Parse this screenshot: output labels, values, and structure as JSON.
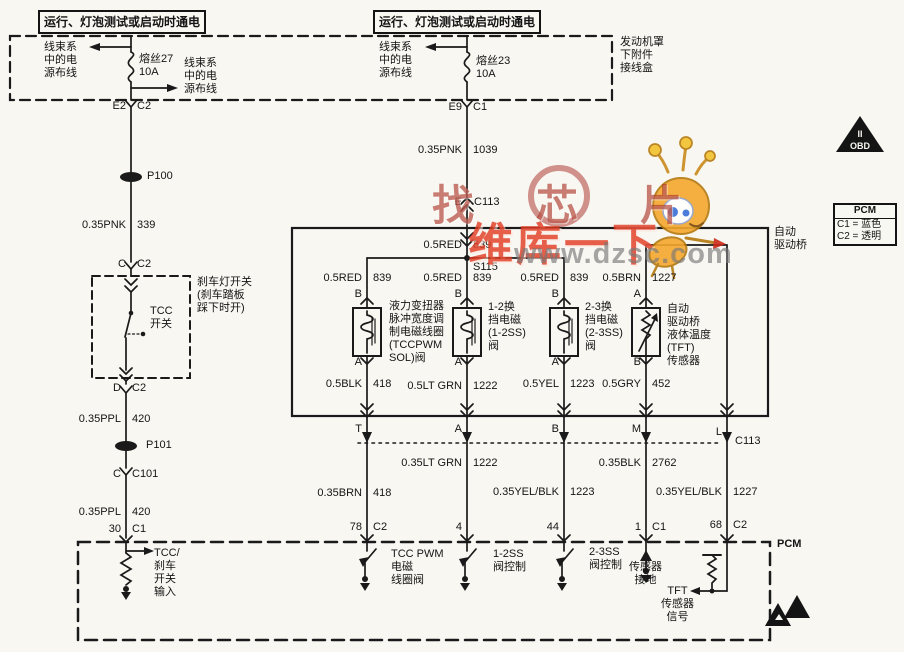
{
  "header": {
    "power_title_left": "运行、灯泡测试或启动时通电",
    "power_title_right": "运行、灯泡测试或启动时通电",
    "junction_box": "发动机罩\n下附件\n接线盒",
    "fuse27": {
      "label": "熔丝27\n10A",
      "left_note": "线束系\n中的电\n源布线",
      "right_note": "线束系\n中的电\n源布线",
      "pin": "E2",
      "conn": "C2"
    },
    "fuse23": {
      "label": "熔丝23\n10A",
      "left_note": "线束系\n中的电\n源布线",
      "pin": "E9",
      "conn": "C1"
    }
  },
  "left_circuit": {
    "p100": "P100",
    "p101": "P101",
    "wire_339": {
      "spec": "0.35PNK",
      "num": "339"
    },
    "conn_c_c2": {
      "pin": "C",
      "conn": "C2"
    },
    "brake_switch_note": "刹车灯开关\n(刹车踏板\n踩下时开)",
    "tcc_switch": "TCC\n开关",
    "conn_d_c2": {
      "pin": "D",
      "conn": "C2"
    },
    "wire_420a": {
      "spec": "0.35PPL",
      "num": "420"
    },
    "conn_c_c101": {
      "pin": "C",
      "conn": "C101"
    },
    "wire_420b": {
      "spec": "0.35PPL",
      "num": "420"
    },
    "pin_30": {
      "pin": "30",
      "conn": "C1"
    },
    "pcm_input": "TCC/\n刹车\n开关\n输入"
  },
  "center_circuit": {
    "wire_1039": {
      "spec": "0.35PNK",
      "num": "1039"
    },
    "conn_e_c113": {
      "pin": "E",
      "conn": "C113"
    },
    "wire_839_main": {
      "spec": "0.5RED",
      "num": "839"
    },
    "splice": "S115"
  },
  "transaxle": {
    "label": "自动\n驱动桥",
    "branches": [
      {
        "wire": {
          "spec": "0.5RED",
          "num": "839"
        },
        "top_term": "B",
        "bottom_term": "A",
        "device": "液力变扭器\n脉冲宽度调\n制电磁线圈\n(TCCPWM\nSOL)阀",
        "bottom_wire": {
          "spec": "0.5BLK",
          "num": "418"
        }
      },
      {
        "wire": {
          "spec": "0.5RED",
          "num": "839"
        },
        "top_term": "B",
        "bottom_term": "A",
        "device": "1-2换\n挡电磁\n(1-2SS)\n阀",
        "bottom_wire": {
          "spec": "0.5LT GRN",
          "num": "1222"
        }
      },
      {
        "wire": {
          "spec": "0.5RED",
          "num": "839"
        },
        "top_term": "B",
        "bottom_term": "A",
        "device": "2-3换\n挡电磁\n(2-3SS)\n阀",
        "bottom_wire": {
          "spec": "0.5YEL",
          "num": "1223"
        }
      },
      {
        "wire": {
          "spec": "0.5BRN",
          "num": "1227"
        },
        "top_term": "A",
        "bottom_term": "B",
        "device": "自动\n驱动桥\n液体温度\n(TFT)\n传感器",
        "bottom_wire": {
          "spec": "0.5GRY",
          "num": "452"
        }
      }
    ]
  },
  "c113": {
    "label": "C113",
    "terminals": [
      "T",
      "A",
      "B",
      "M",
      "L"
    ],
    "wires": [
      {
        "spec": "0.35BRN",
        "num": "418",
        "pin": "78",
        "conn": "C2"
      },
      {
        "spec": "0.35LT GRN",
        "num": "1222",
        "pin": "4",
        "conn": ""
      },
      {
        "spec": "0.35YEL/BLK",
        "num": "1223",
        "pin": "44",
        "conn": ""
      },
      {
        "spec": "0.35BLK",
        "num": "2762",
        "pin": "1",
        "conn": "C1"
      },
      {
        "spec": "0.35YEL/BLK",
        "num": "1227",
        "pin": "68",
        "conn": "C2"
      }
    ]
  },
  "pcm": {
    "label": "PCM",
    "drivers": [
      "TCC PWM\n电磁\n线圈阀",
      "1-2SS\n阀控制",
      "2-3SS\n阀控制"
    ],
    "sensor_ground": "传感器\n接地",
    "tft_signal": "TFT\n传感器\n信号"
  },
  "legend": {
    "title": "PCM",
    "rows": [
      "C1 = 蓝色",
      "C2 = 透明"
    ]
  },
  "icons": {
    "obd_line1": "II",
    "obd_line2": "OBD"
  },
  "watermark": {
    "text1": "找芯片",
    "text2": "维库一下",
    "url": "www.dzsc.com"
  }
}
